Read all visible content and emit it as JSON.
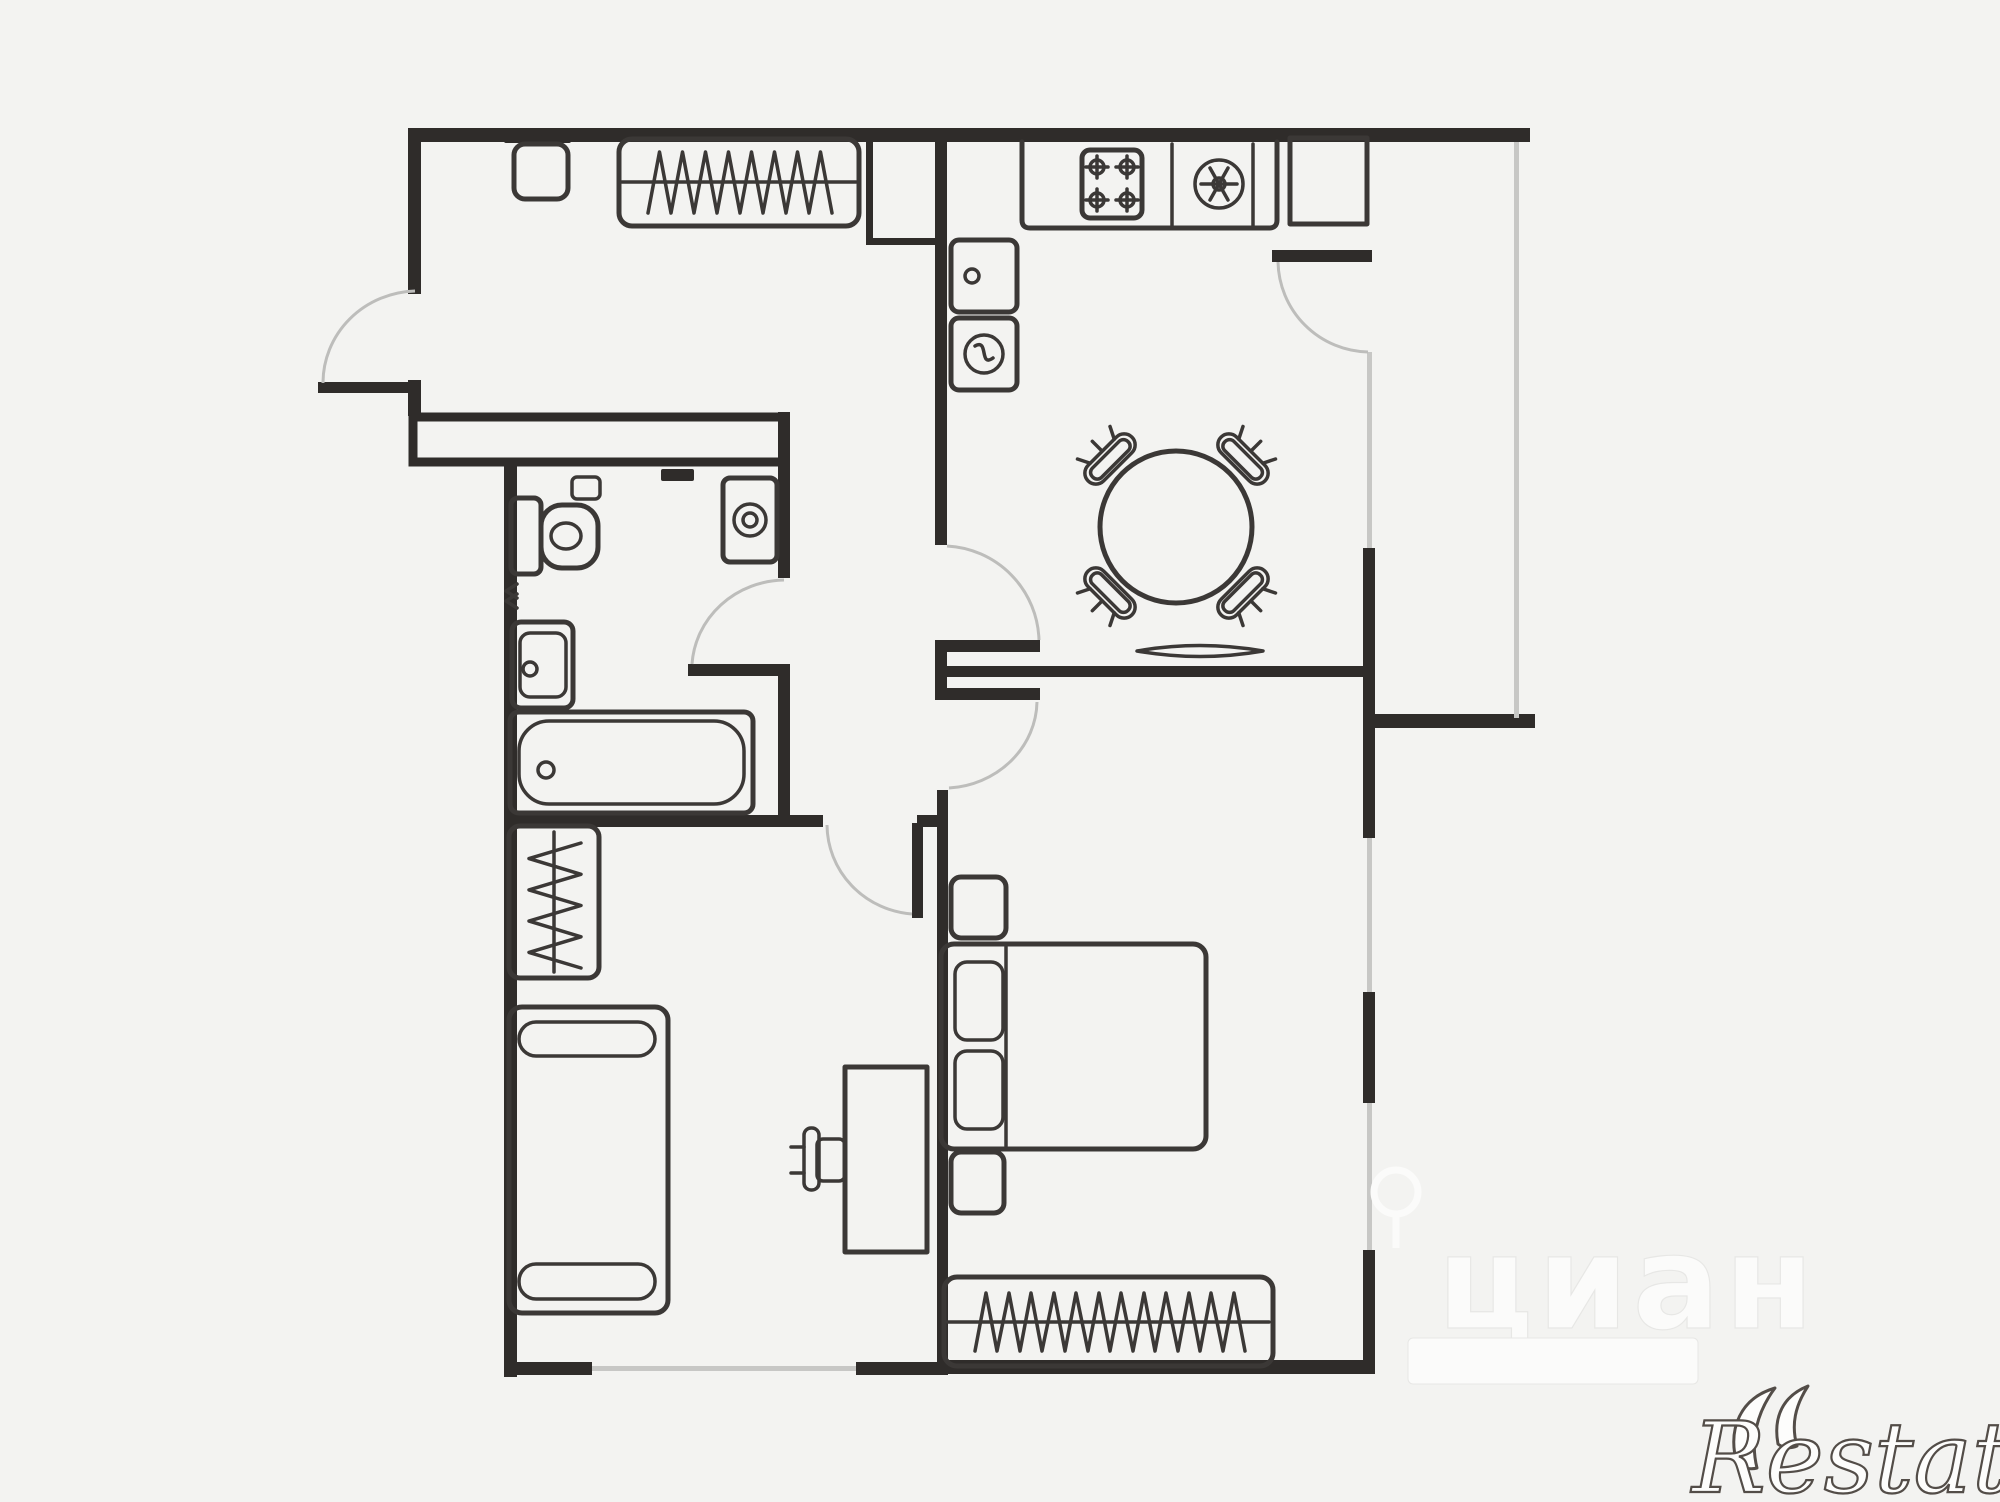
{
  "page": {
    "background": "#f3f3f1",
    "kind": "real-estate floor plan screenshot"
  },
  "palette": {
    "bg": "#f3f3f1",
    "wall": "#2f2c2a",
    "furn": "#3b3836",
    "arc": "#bdbdbb",
    "glass": "#c7c7c5",
    "wm-fill": "#fbfbfa",
    "wm-edge": "#e7e7e5",
    "restate-stroke": "#534d48"
  },
  "watermarks": {
    "cian_text": "циан",
    "cian_logo": "cian-pin-icon",
    "cian_subtitle_legible": false,
    "restate_text": "Restate",
    "restate_logo": "double-crescent-icon"
  },
  "plan": {
    "rooms": [
      "entry-hall",
      "inner-corridor",
      "bathroom",
      "kitchen-living-room",
      "balcony",
      "bedroom",
      "second-room"
    ],
    "fixtures_and_furniture": [
      "entry-wall-cabinet",
      "hall-wardrobe-hangers",
      "vent-shaft",
      "kitchen-counter",
      "stove-4-burners-icon",
      "kitchen-sink-icon",
      "dishwasher-icon",
      "washer-drum-icon",
      "refrigerator",
      "round-dining-table",
      "dining-chair",
      "dining-chair",
      "dining-chair",
      "dining-chair",
      "radiator-lens",
      "toilet",
      "toilet-paper-holder",
      "washing-machine-spiral-icon",
      "towel-rail-zigzag",
      "wash-basin",
      "bathtub",
      "sofa-with-armrests",
      "wardrobe-hangers-vertical",
      "desk",
      "desk-chair",
      "double-bed",
      "pillow",
      "pillow",
      "nightstand",
      "nightstand",
      "bedroom-wardrobe-hangers",
      "doors-with-swing-arcs",
      "windows-thin-glazing"
    ]
  }
}
